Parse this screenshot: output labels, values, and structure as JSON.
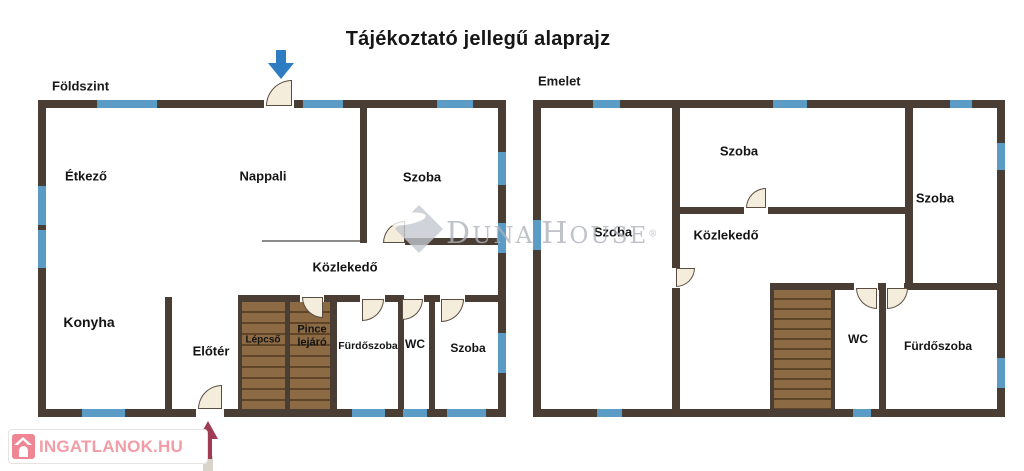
{
  "title": "Tájékoztató jellegű alaprajz",
  "watermark": {
    "text": "Duna House",
    "reg": "®"
  },
  "logo": {
    "text": "INGATLANOK.HU"
  },
  "colors": {
    "wall": "#4a3e34",
    "window": "#5a9cc5",
    "door_fill": "#f4eddb",
    "door_stroke": "#5a4c40",
    "stair_fill": "#8b6a44",
    "stair_line": "#5f4427",
    "thin_line": "#8b8b8b",
    "arrow_blue": "#2e7cc1",
    "arrow_maroon": "#a03b54",
    "arrow_tail": "#d8d3cb"
  },
  "floors": [
    {
      "name": "Földszint",
      "name_pos": [
        52,
        86
      ],
      "walls": [
        [
          38,
          100,
          468,
          8
        ],
        [
          38,
          100,
          8,
          317
        ],
        [
          498,
          100,
          8,
          317
        ],
        [
          38,
          409,
          468,
          8
        ],
        [
          360,
          108,
          7,
          135
        ],
        [
          405,
          238,
          93,
          7
        ],
        [
          165,
          297,
          7,
          112
        ],
        [
          238,
          295,
          260,
          7
        ],
        [
          238,
          295,
          4,
          114
        ],
        [
          285,
          295,
          5,
          114
        ],
        [
          330,
          295,
          7,
          114
        ],
        [
          398,
          295,
          6,
          114
        ],
        [
          429,
          295,
          6,
          114
        ]
      ],
      "gaps": [
        [
          264,
          100,
          30,
          8
        ],
        [
          196,
          409,
          28,
          8
        ],
        [
          367,
          238,
          38,
          7
        ],
        [
          300,
          295,
          24,
          7
        ],
        [
          360,
          295,
          25,
          7
        ],
        [
          404,
          295,
          20,
          7
        ],
        [
          440,
          295,
          25,
          7
        ]
      ],
      "windows": [
        [
          97,
          100,
          60,
          8
        ],
        [
          303,
          100,
          40,
          8
        ],
        [
          437,
          100,
          36,
          8
        ],
        [
          38,
          186,
          8,
          39
        ],
        [
          38,
          230,
          8,
          38
        ],
        [
          498,
          152,
          8,
          33
        ],
        [
          498,
          223,
          8,
          30
        ],
        [
          498,
          333,
          8,
          40
        ],
        [
          82,
          409,
          43,
          8
        ],
        [
          352,
          409,
          33,
          8
        ],
        [
          403,
          409,
          24,
          8
        ],
        [
          447,
          409,
          39,
          8
        ]
      ],
      "lines": [
        [
          262,
          240,
          98,
          2
        ]
      ],
      "stairs": [
        {
          "r": [
            242,
            302,
            43,
            107
          ],
          "pitch": 11
        },
        {
          "r": [
            290,
            302,
            40,
            107
          ],
          "pitch": 11
        }
      ],
      "doors": [
        [
          266,
          80,
          26,
          "br"
        ],
        [
          198,
          385,
          24,
          "br"
        ],
        [
          383,
          221,
          22,
          "br"
        ],
        [
          302,
          297,
          21,
          "tr"
        ],
        [
          362,
          299,
          22,
          "tl"
        ],
        [
          402,
          299,
          21,
          "tl"
        ],
        [
          441,
          299,
          23,
          "tl"
        ]
      ],
      "labels": [
        {
          "t": "Étkező",
          "x": 86,
          "y": 177,
          "fs": 13
        },
        {
          "t": "Nappali",
          "x": 263,
          "y": 177,
          "fs": 13
        },
        {
          "t": "Szoba",
          "x": 422,
          "y": 178,
          "fs": 13
        },
        {
          "t": "Közlekedő",
          "x": 345,
          "y": 268,
          "fs": 13
        },
        {
          "t": "Konyha",
          "x": 89,
          "y": 322,
          "fs": 14
        },
        {
          "t": "Előtér",
          "x": 211,
          "y": 352,
          "fs": 13
        },
        {
          "t": "Lépcső",
          "x": 263,
          "y": 340,
          "fs": 10
        },
        {
          "t": "Pince lejáró",
          "x": 312,
          "y": 336,
          "fs": 11,
          "w": 48
        },
        {
          "t": "Fürdőszoba",
          "x": 368,
          "y": 346,
          "fs": 10.5
        },
        {
          "t": "WC",
          "x": 415,
          "y": 345,
          "fs": 12
        },
        {
          "t": "Szoba",
          "x": 468,
          "y": 349,
          "fs": 12
        }
      ]
    },
    {
      "name": "Emelet",
      "name_pos": [
        538,
        81
      ],
      "walls": [
        [
          533,
          100,
          472,
          8
        ],
        [
          533,
          100,
          8,
          317
        ],
        [
          997,
          100,
          8,
          317
        ],
        [
          533,
          409,
          472,
          8
        ],
        [
          672,
          108,
          8,
          160
        ],
        [
          672,
          288,
          8,
          121
        ],
        [
          680,
          207,
          227,
          7
        ],
        [
          905,
          108,
          8,
          177
        ],
        [
          905,
          283,
          92,
          7
        ],
        [
          835,
          283,
          70,
          7
        ],
        [
          879,
          283,
          7,
          126
        ],
        [
          770,
          283,
          4,
          126
        ],
        [
          831,
          283,
          4,
          126
        ],
        [
          770,
          283,
          65,
          7
        ]
      ],
      "gaps": [
        [
          744,
          207,
          24,
          7
        ],
        [
          854,
          283,
          24,
          7
        ],
        [
          886,
          283,
          18,
          7
        ]
      ],
      "windows": [
        [
          593,
          100,
          27,
          8
        ],
        [
          773,
          100,
          34,
          8
        ],
        [
          950,
          100,
          22,
          8
        ],
        [
          533,
          220,
          8,
          30
        ],
        [
          997,
          143,
          8,
          27
        ],
        [
          997,
          358,
          8,
          30
        ],
        [
          597,
          409,
          25,
          8
        ],
        [
          853,
          409,
          18,
          8
        ]
      ],
      "lines": [],
      "stairs": [
        {
          "r": [
            774,
            290,
            57,
            119
          ],
          "pitch": 10
        }
      ],
      "doors": [
        [
          746,
          188,
          20,
          "br"
        ],
        [
          676,
          268,
          19,
          "tl"
        ],
        [
          856,
          288,
          21,
          "tr"
        ],
        [
          887,
          288,
          21,
          "tl"
        ]
      ],
      "labels": [
        {
          "t": "Szoba",
          "x": 613,
          "y": 233,
          "fs": 13
        },
        {
          "t": "Szoba",
          "x": 739,
          "y": 152,
          "fs": 13
        },
        {
          "t": "Szoba",
          "x": 935,
          "y": 199,
          "fs": 13
        },
        {
          "t": "Közlekedő",
          "x": 726,
          "y": 236,
          "fs": 13
        },
        {
          "t": "WC",
          "x": 858,
          "y": 340,
          "fs": 12
        },
        {
          "t": "Fürdőszoba",
          "x": 938,
          "y": 347,
          "fs": 12
        }
      ]
    }
  ],
  "arrows": [
    {
      "dir": "down",
      "x": 268,
      "y": 50,
      "w": 26,
      "h": 29
    },
    {
      "dir": "up",
      "x": 198,
      "y": 421,
      "w": 21,
      "h": 50
    }
  ]
}
